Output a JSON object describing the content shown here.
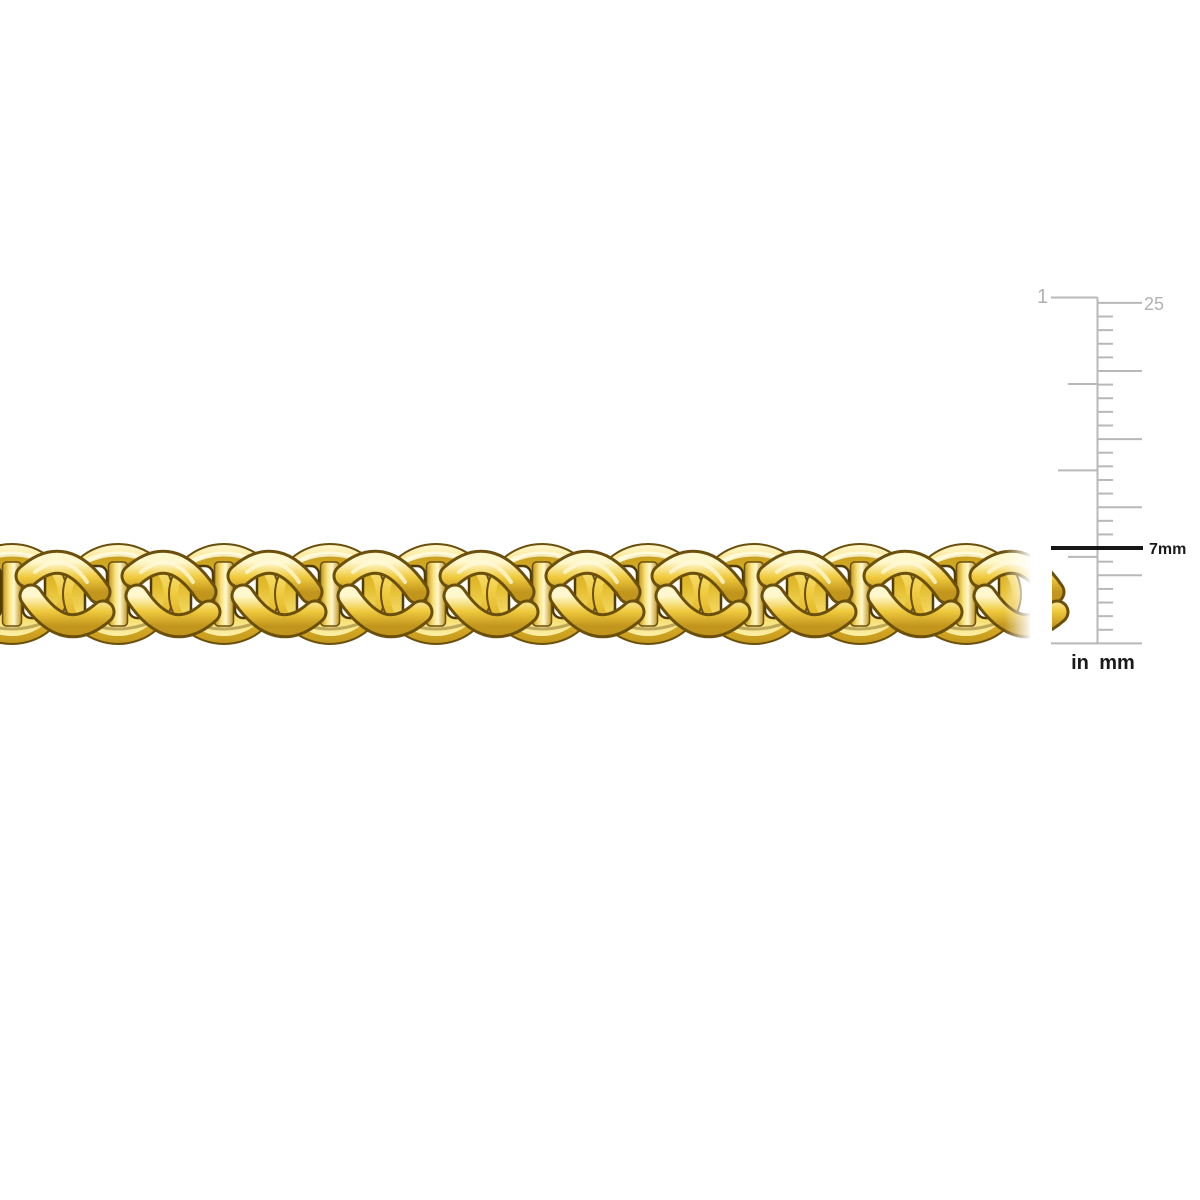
{
  "page": {
    "background": "#ffffff"
  },
  "product": {
    "name": "yellow-gold-mariner-link-chain",
    "description": "Polished yellow gold mariner (anchor) link chain shown horizontally across the middle of the image, cropped at both ends",
    "link_count": 10,
    "colors": {
      "highlight": "#fff8cf",
      "light": "#f9e27a",
      "mid": "#f0cb3f",
      "deep": "#ddb125",
      "dark": "#c2961c",
      "inner_dark": "#c79e1c",
      "inner_mid": "#e3bd2e",
      "inner_light": "#f4da66",
      "inner_highlight": "#fcf0a8",
      "outline": "#6b4f0c",
      "crevice": "#513b07",
      "window": "#ffffff"
    }
  },
  "ruler": {
    "top_inch_label": "1",
    "top_mm_label": "25",
    "marker_label": "7mm",
    "unit_labels": {
      "left": "in",
      "right": "mm"
    },
    "mm_max": 25,
    "mm_long_tick_every": 5,
    "inch_fractions": [
      1,
      0.75,
      0.5,
      0.25
    ],
    "marker_mm": 7,
    "tick_color": "#b8b8b8",
    "label_gray": "#b2b2b2",
    "marker_color": "#161616",
    "text_color": "#1a1a1a"
  }
}
